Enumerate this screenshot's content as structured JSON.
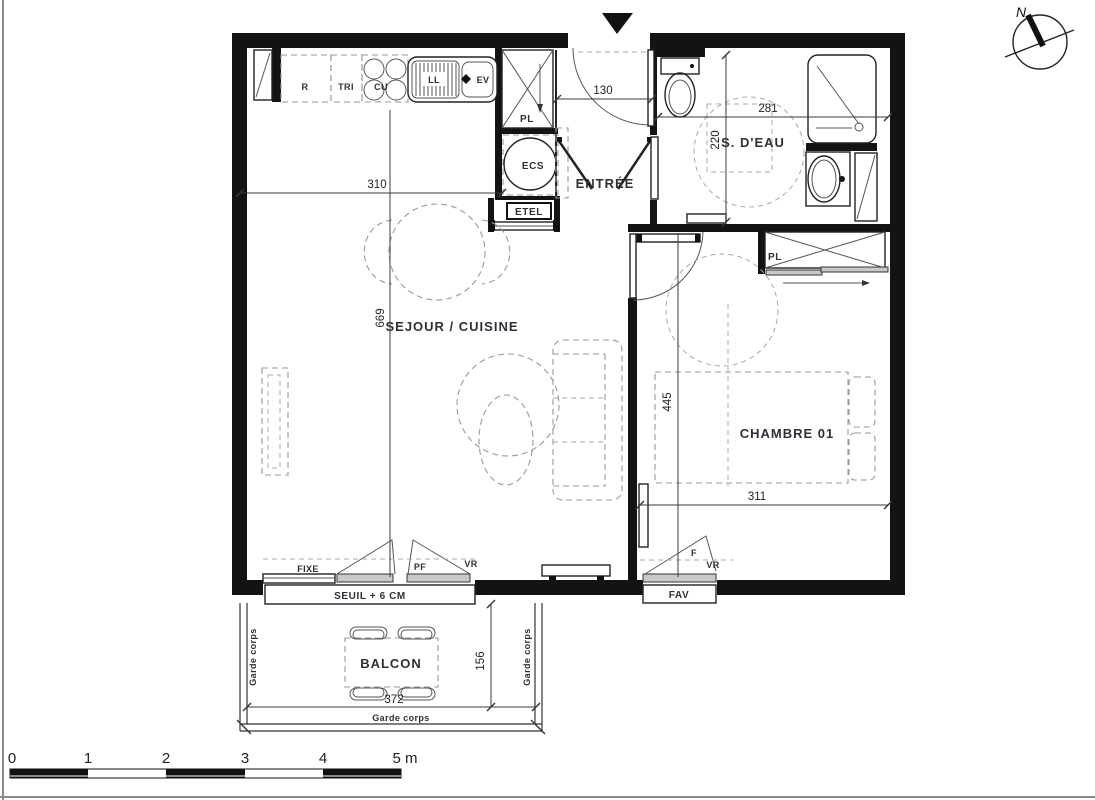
{
  "compass": {
    "label": "N"
  },
  "rooms": {
    "sejour": "SEJOUR / CUISINE",
    "entree": "ENTRÉE",
    "sdeau": "S. D'EAU",
    "chambre": "CHAMBRE 01",
    "balcon": "BALCON"
  },
  "kitchen": {
    "fridge": "R",
    "tri": "TRI",
    "hob": "CU",
    "ll": "LL",
    "sink": "EV"
  },
  "storage": {
    "pl_entree": "PL",
    "ecs": "ECS",
    "etel": "ETEL",
    "pl_chambre": "PL"
  },
  "openings": {
    "fixe": "FIXE",
    "pf": "PF",
    "vr_sejour": "VR",
    "seuil": "SEUIL + 6 CM",
    "f": "F",
    "vr_chambre": "VR",
    "fav": "FAV"
  },
  "balcony": {
    "garde_left": "Garde corps",
    "garde_right": "Garde corps",
    "garde_bottom": "Garde corps"
  },
  "dims": {
    "sejour_w": "310",
    "entree_w": "130",
    "sdeau_w": "281",
    "sdeau_d": "220",
    "sejour_h": "669",
    "chambre_h": "445",
    "chambre_w": "311",
    "balcon_w": "372",
    "balcon_d": "156"
  },
  "scale": {
    "ticks": [
      "0",
      "1",
      "2",
      "3",
      "4",
      "5 m"
    ]
  },
  "colors": {
    "wall": "#131313",
    "line": "#222222",
    "furniture_dash": "#999999",
    "text": "#2e3038"
  }
}
